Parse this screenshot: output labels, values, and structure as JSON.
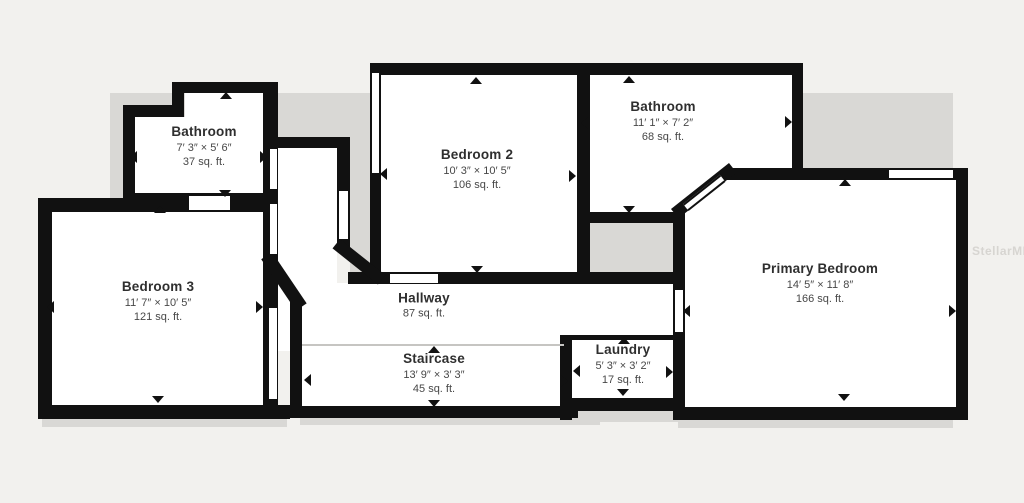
{
  "watermark": "StellarMLS",
  "colors": {
    "wall": "#111111",
    "room_fill": "#ffffff",
    "background": "#f2f1ee",
    "shadow": "#d9d8d5",
    "title_text": "#2f2f2f",
    "dim_text": "#474747",
    "watermark_text": "#d7d5d1"
  },
  "rooms": [
    {
      "name": "Bathroom",
      "dims": "7′ 3″ × 5′ 6″",
      "area": "37 sq. ft."
    },
    {
      "name": "Bedroom 3",
      "dims": "11′ 7″ × 10′ 5″",
      "area": "121 sq. ft."
    },
    {
      "name": "Bedroom 2",
      "dims": "10′ 3″ × 10′ 5″",
      "area": "106 sq. ft."
    },
    {
      "name": "Bathroom",
      "dims": "11′ 1″ × 7′ 2″",
      "area": "68 sq. ft."
    },
    {
      "name": "Primary Bedroom",
      "dims": "14′ 5″ × 11′ 8″",
      "area": "166 sq. ft."
    },
    {
      "name": "Hallway",
      "dims": "",
      "area": "87 sq. ft."
    },
    {
      "name": "Staircase",
      "dims": "13′ 9″ × 3′ 3″",
      "area": "45 sq. ft."
    },
    {
      "name": "Laundry",
      "dims": "5′ 3″ × 3′ 2″",
      "area": "17 sq. ft."
    }
  ]
}
